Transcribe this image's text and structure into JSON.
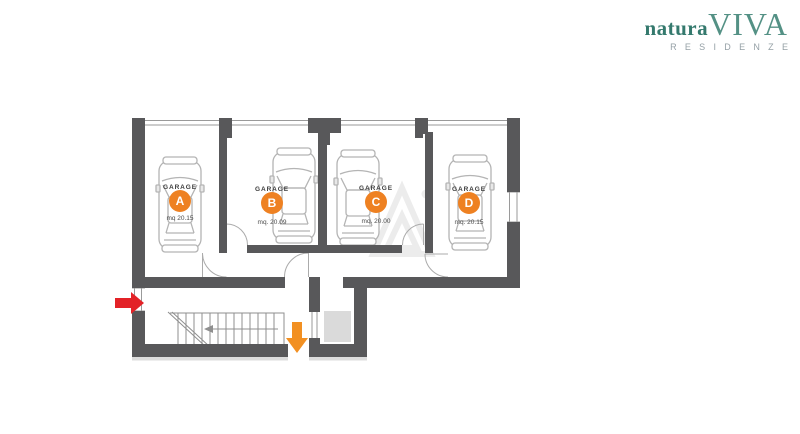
{
  "brand": {
    "name_part1": "natura",
    "name_part2": "VIVA",
    "tagline": "RESIDENZE",
    "color_dark": "#34796D",
    "color_light": "#549185",
    "tagline_color": "#95A0A6"
  },
  "plan": {
    "garages": [
      {
        "name": "GARAGE",
        "letter": "A",
        "area": "mq 20.15"
      },
      {
        "name": "GARAGE",
        "letter": "B",
        "area": "mq. 20.09"
      },
      {
        "name": "GARAGE",
        "letter": "C",
        "area": "mq. 20.00"
      },
      {
        "name": "GARAGE",
        "letter": "D",
        "area": "mq. 20.15"
      }
    ],
    "badge_color": "#EE8122",
    "wall_color": "#58585A",
    "entrance_arrow_color": "#E32227",
    "down_arrow_color": "#F29022"
  }
}
